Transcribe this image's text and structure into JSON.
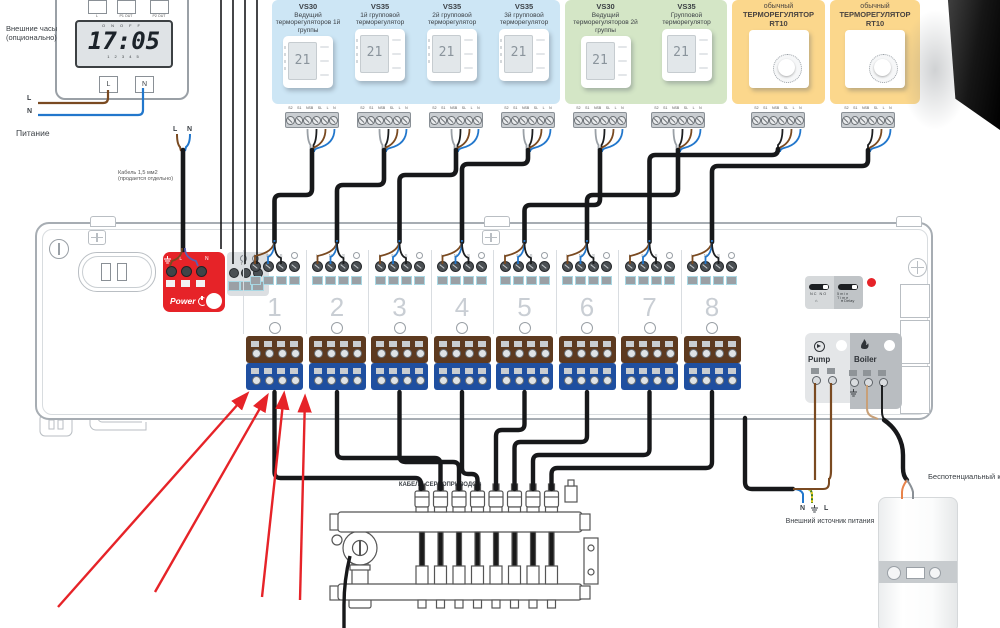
{
  "clock": {
    "label": "Внешние часы (опционально)",
    "top_terminals": [
      "L",
      "P1 OUT",
      "P2 OUT"
    ],
    "on": "ON",
    "off": "OFF",
    "time": "17:05",
    "scale": "1 2 3 4 5",
    "bottom_terminals": [
      "L",
      "N"
    ],
    "wire_l": "L",
    "wire_n": "N"
  },
  "power": {
    "label": "Питание",
    "l": "L",
    "n": "N",
    "cable_note_1": "Кабель 1,5 мм2",
    "cable_note_2": "(продается отдельно)"
  },
  "strip_labels": [
    "S2",
    "S1",
    "NSB",
    "SL",
    "L",
    "N"
  ],
  "panels": {
    "blue": [
      {
        "model": "VS30",
        "desc": "Ведущий терморегуляторов 1й группы",
        "display": "21"
      },
      {
        "model": "VS35",
        "desc": "1й групповой терморегулятор",
        "display": "21"
      },
      {
        "model": "VS35",
        "desc": "2й групповой терморегулятор",
        "display": "21"
      },
      {
        "model": "VS35",
        "desc": "3й групповой терморегулятор",
        "display": "21"
      }
    ],
    "green": [
      {
        "model": "VS30",
        "desc": "Ведущий терморегуляторов 2й группы",
        "display": "21"
      },
      {
        "model": "VS35",
        "desc": "Групповой терморегулятор",
        "display": "21"
      }
    ],
    "orange1": [
      {
        "prefix": "обычный",
        "name": "ТЕРМОРЕГУЛЯТОР",
        "model": "RT10"
      }
    ],
    "orange2": [
      {
        "prefix": "обычный",
        "name": "ТЕРМОРЕГУЛЯТОР",
        "model": "RT10"
      }
    ]
  },
  "controller": {
    "power_label": "Power",
    "power_terminals": {
      "l": "L",
      "n": "N"
    },
    "aux": {
      "t4": "T4",
      "sb": "SB"
    },
    "zone_labels": [
      "L",
      "N",
      "S"
    ],
    "zones": [
      "1",
      "2",
      "3",
      "4",
      "5",
      "6",
      "7",
      "8"
    ],
    "switch": {
      "nc": "NC",
      "no": "NO",
      "t1": "5min",
      "t2": "Time",
      "delay": "Delay"
    },
    "pump": "Pump",
    "boiler": "Boiler"
  },
  "bottom": {
    "servo": "КАБЕЛИ СЕРВОПРИВОДОВ",
    "source": {
      "n": "N",
      "l": "L",
      "label": "Внешний источник питания"
    },
    "contact": "Беспотенциальный контакт"
  },
  "colors": {
    "panel_blue": "#cde6f5",
    "panel_green": "#d4e6c6",
    "panel_orange": "#fbd78c",
    "accent_red": "#e62328",
    "wire_brown": "#7a4a21",
    "wire_blue": "#2277cc",
    "wire_gray": "#9aa0a6",
    "wire_black": "#17181a",
    "terminal_brown": "#5d3a20",
    "terminal_blue": "#1f4fa0"
  }
}
